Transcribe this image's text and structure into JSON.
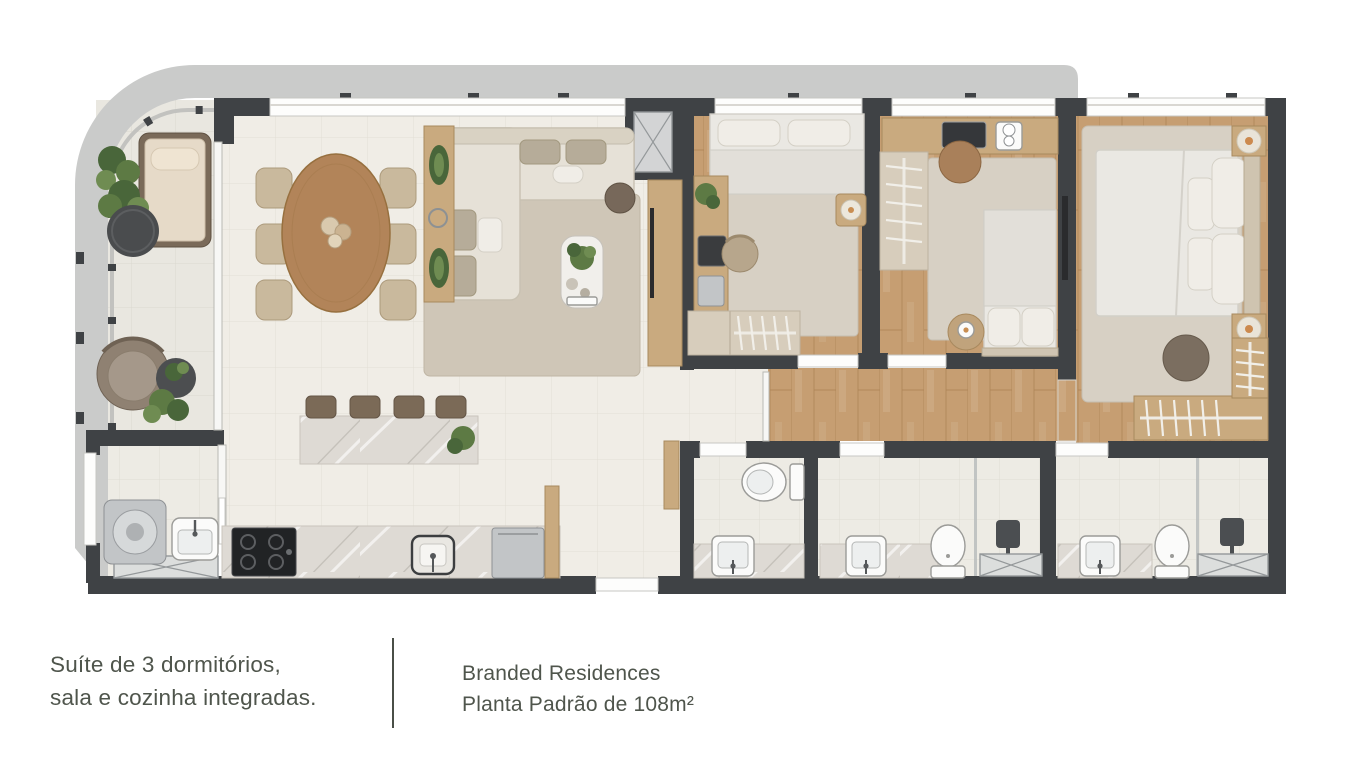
{
  "captions": {
    "left": {
      "line1": "Suíte de 3 dormitórios,",
      "line2": "sala e cozinha integradas."
    },
    "right": {
      "line1": "Branded Residences",
      "line2": "Planta Padrão de 108m²"
    }
  },
  "palette": {
    "background": "#ffffff",
    "wall": "#3f4245",
    "slab": "#cacbca",
    "floor-tile": "#f0ede6",
    "tile-line": "#e2ded5",
    "balcony-tile": "#e9e7e0",
    "balcony-line": "#dbd8d0",
    "bath-tile": "#edebe4",
    "bath-line": "#dfdcd4",
    "wood": "#c69e72",
    "wood-dark": "#ad8256",
    "wood-furniture": "#c9aa7f",
    "marble": "#dedad4",
    "rug": "#d7d0c4",
    "rug-living": "#cfc6b7",
    "sofa": "#e6e1d7",
    "bed": "#eae8e3",
    "wardrobe": "#d7cdbc",
    "plant": "#5d7a44",
    "plant-dark": "#49663a",
    "plant-light": "#6f8c52",
    "fixture": "#fbfbfa",
    "steel": "#c2c5c7",
    "dark-fixture": "#2a2b2d",
    "glass": "#f7f7f5",
    "text": "#4f554c",
    "divider": "#4a4f47"
  }
}
